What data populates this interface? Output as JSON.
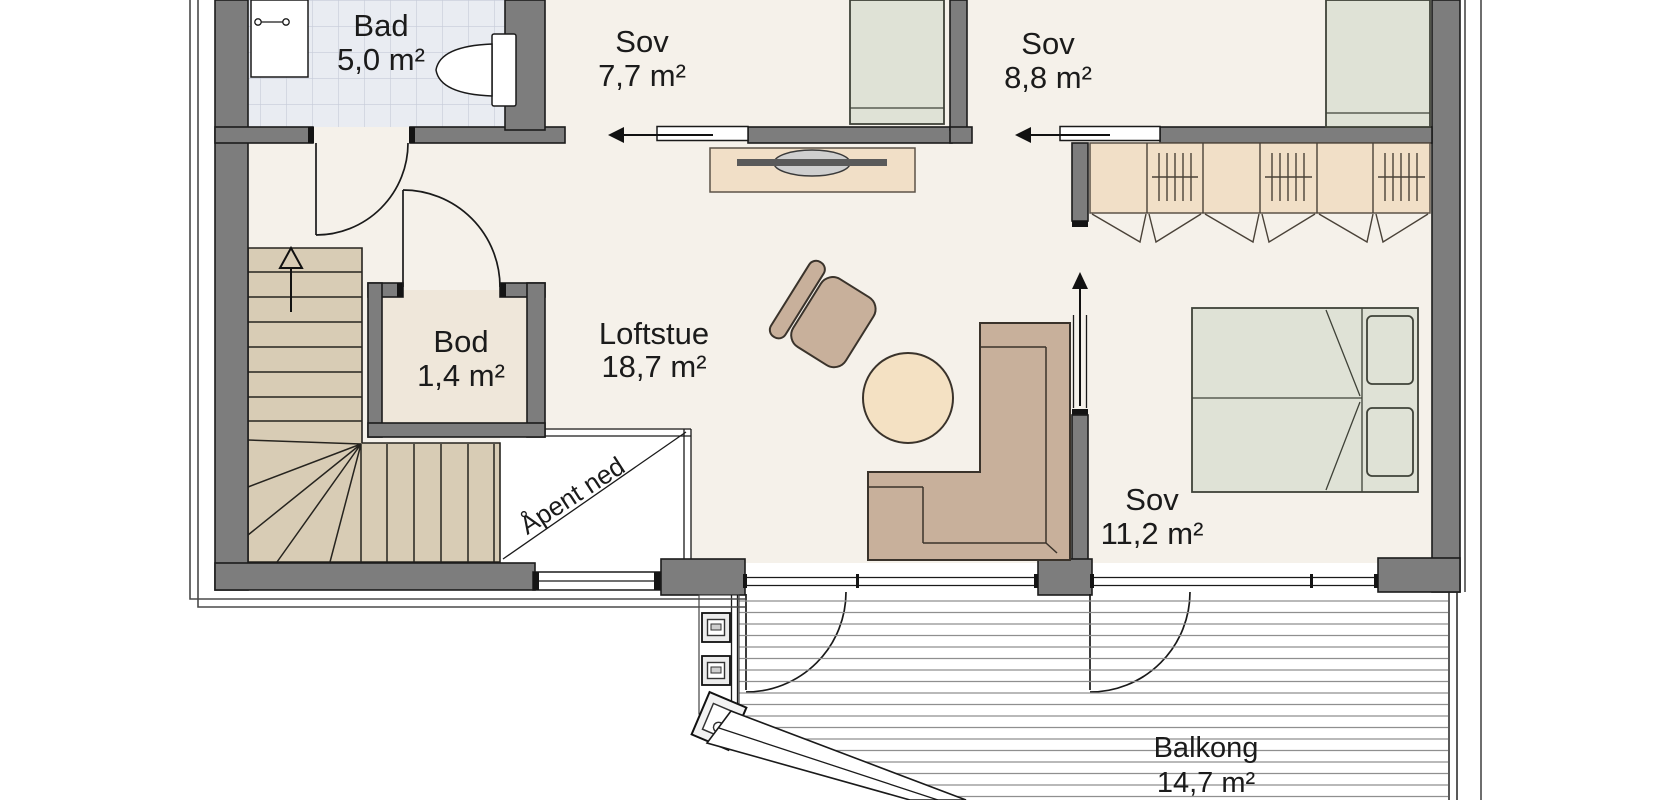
{
  "rooms": {
    "bathroom": {
      "name": "Bad",
      "area": "5,0 m²"
    },
    "bedroom_small": {
      "name": "Sov",
      "area": "7,7 m²"
    },
    "bedroom_medium": {
      "name": "Sov",
      "area": "8,8 m²"
    },
    "storage": {
      "name": "Bod",
      "area": "1,4 m²"
    },
    "loft_lounge": {
      "name": "Loftstue",
      "area": "18,7 m²"
    },
    "bedroom_master": {
      "name": "Sov",
      "area": "11,2 m²"
    },
    "balcony": {
      "name": "Balkong",
      "area": "14,7 m²"
    },
    "open_below": {
      "label": "Åpent ned"
    }
  },
  "colors": {
    "wall": "#7d7d7d",
    "outline": "#1c1c1c",
    "floor": "#f5f1ea",
    "tile": "#e9ecf2",
    "tile_line": "#c6cbd8",
    "stairs": "#d8ccb5",
    "storage_floor": "#efe7da",
    "furniture_wood": "#c8b09b",
    "furniture_light": "#f1dfc7",
    "table": "#f4e1c3",
    "bed": "#dfe2d6"
  }
}
